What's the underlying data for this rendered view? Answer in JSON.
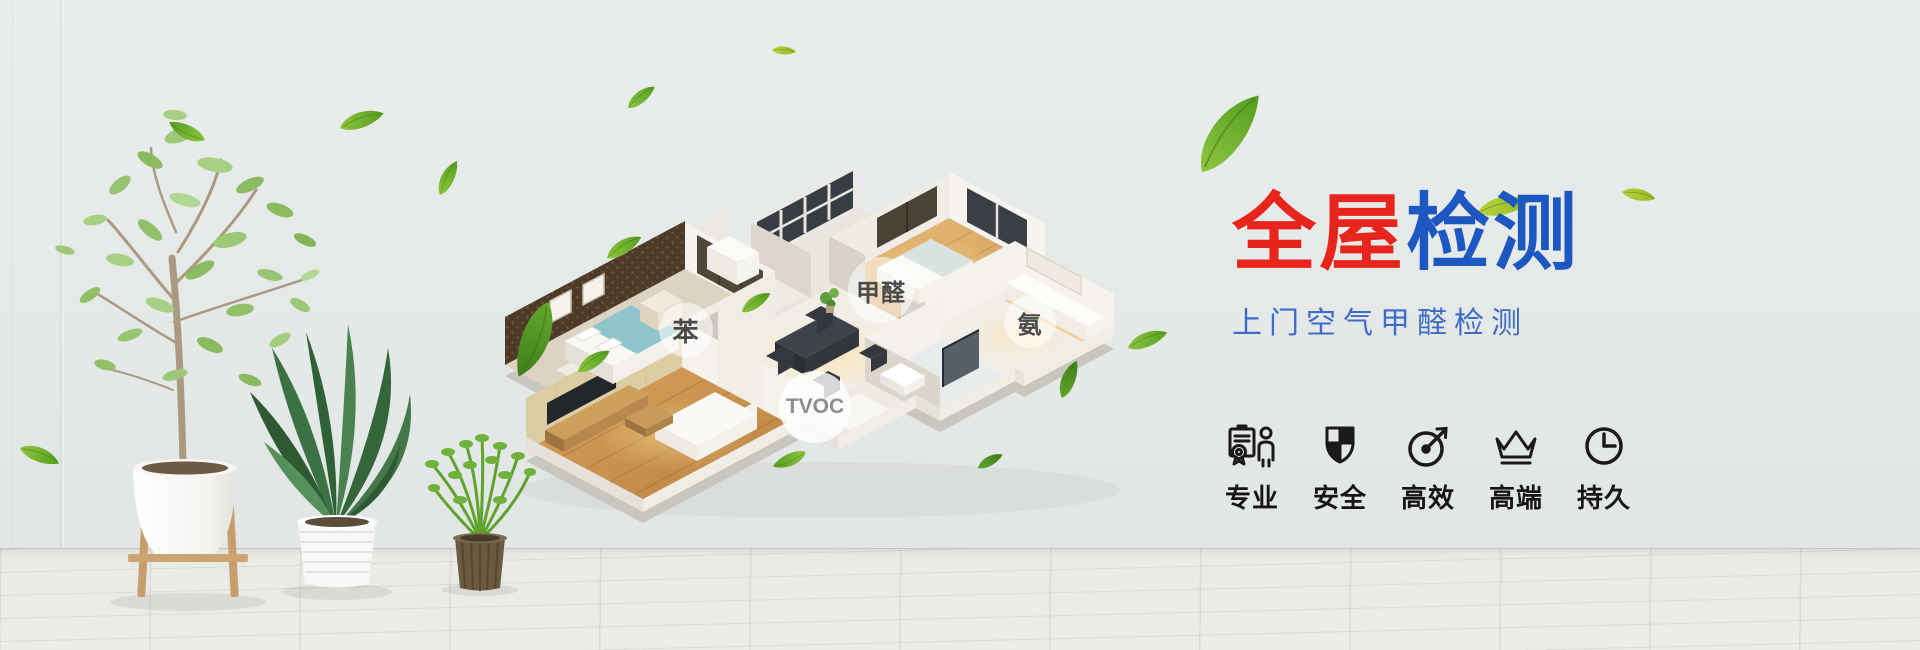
{
  "banner": {
    "title": {
      "part1": "全屋",
      "part2": "检测"
    },
    "subtitle": {
      "text": "上门空气甲醛检测"
    },
    "house_labels": [
      {
        "text": "苯"
      },
      {
        "text": "甲醛"
      },
      {
        "text": "氨"
      },
      {
        "text": "TVOC"
      }
    ],
    "features": {
      "items": [
        {
          "icon": "certificate-person-icon",
          "label": "专业"
        },
        {
          "icon": "shield-check-icon",
          "label": "安全"
        },
        {
          "icon": "gauge-arrow-icon",
          "label": "高效"
        },
        {
          "icon": "crown-icon",
          "label": "高端"
        },
        {
          "icon": "clock-icon",
          "label": "持久"
        }
      ]
    },
    "colors": {
      "title_red": "#e8251c",
      "title_blue": "#1d57c2",
      "subtitle_blue": "#3e6bc5",
      "icon_black": "#1a1a1a",
      "leaf_green": "#6cae2a",
      "wall_background": "#e5e9e8"
    }
  }
}
